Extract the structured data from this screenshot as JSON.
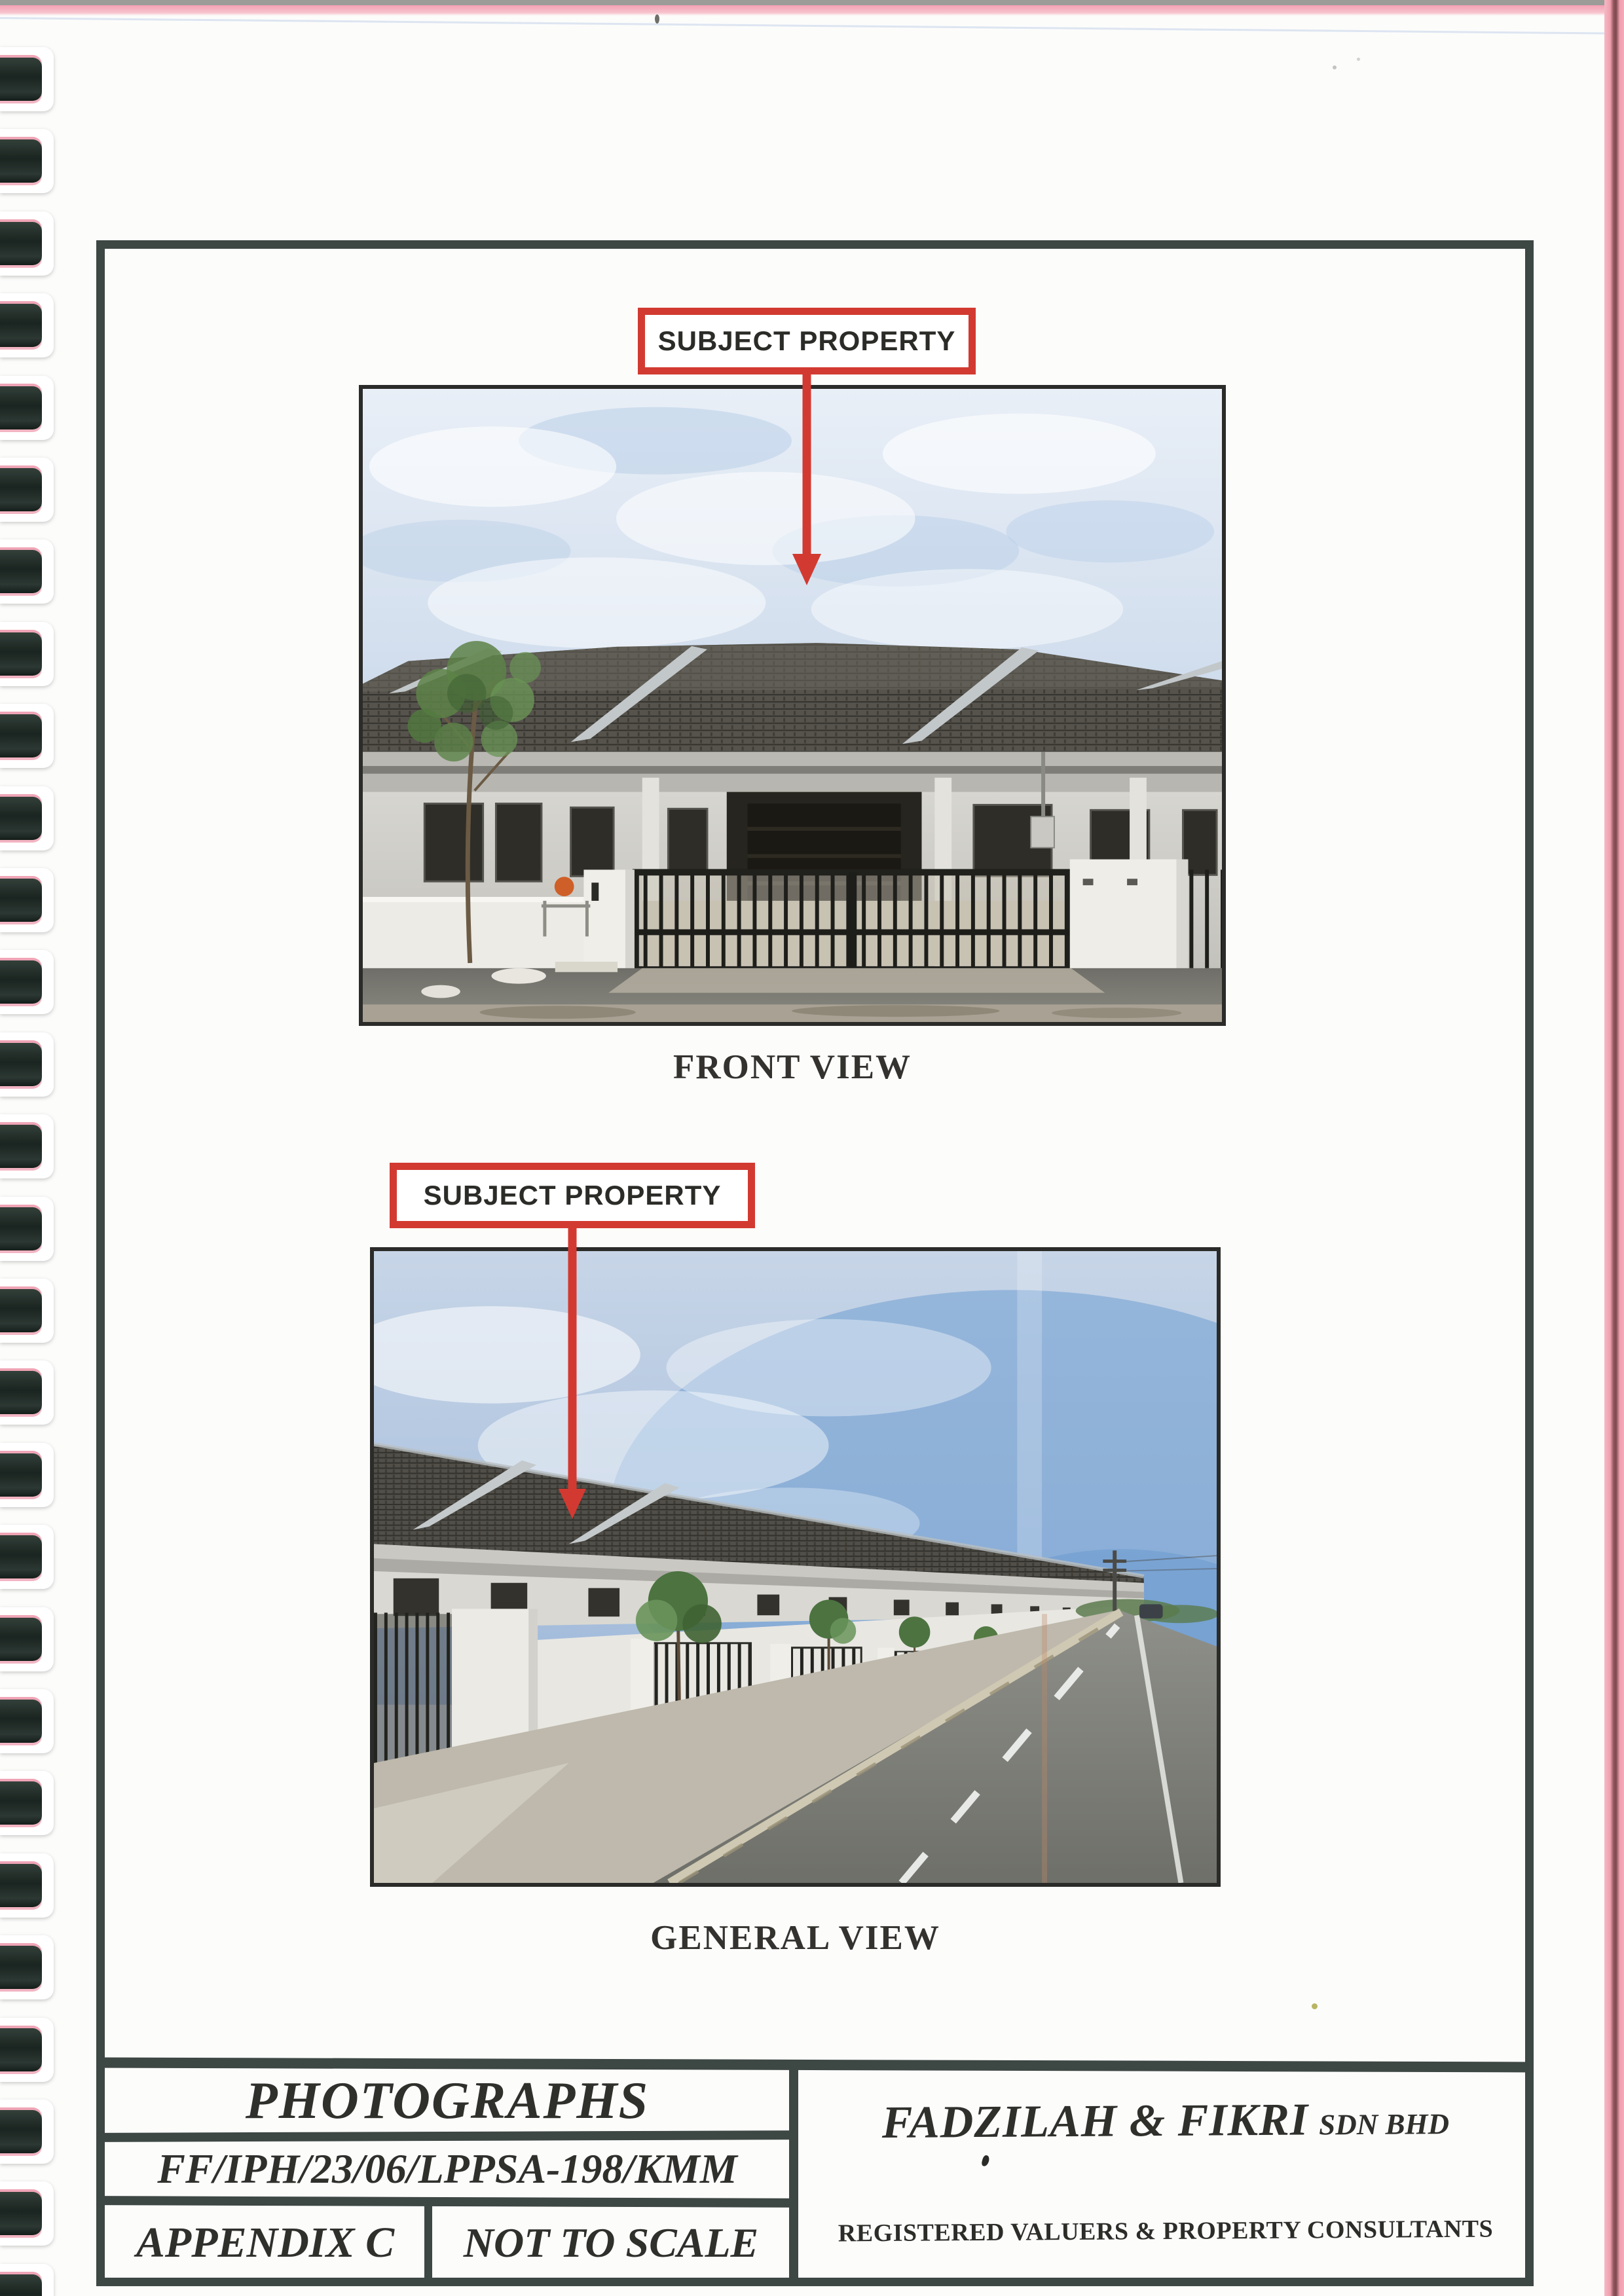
{
  "annotations": {
    "label1": "SUBJECT PROPERTY",
    "label2": "SUBJECT PROPERTY"
  },
  "photos": [
    {
      "caption": "FRONT VIEW"
    },
    {
      "caption": "GENERAL VIEW"
    }
  ],
  "footer": {
    "title": "PHOTOGRAPHS",
    "reference": "FF/IPH/23/06/LPPSA-198/KMM",
    "appendix": "APPENDIX C",
    "scale": "NOT TO SCALE",
    "company_name": "FADZILAH & FIKRI",
    "company_suffix": "SDN BHD",
    "company_tagline": "REGISTERED VALUERS & PROPERTY CONSULTANTS"
  },
  "colors": {
    "annotation_red": "#d23a31",
    "frame_dark": "#3d4743",
    "binding_dark": "#222d28",
    "scan_pink": "#f2a2b2"
  }
}
